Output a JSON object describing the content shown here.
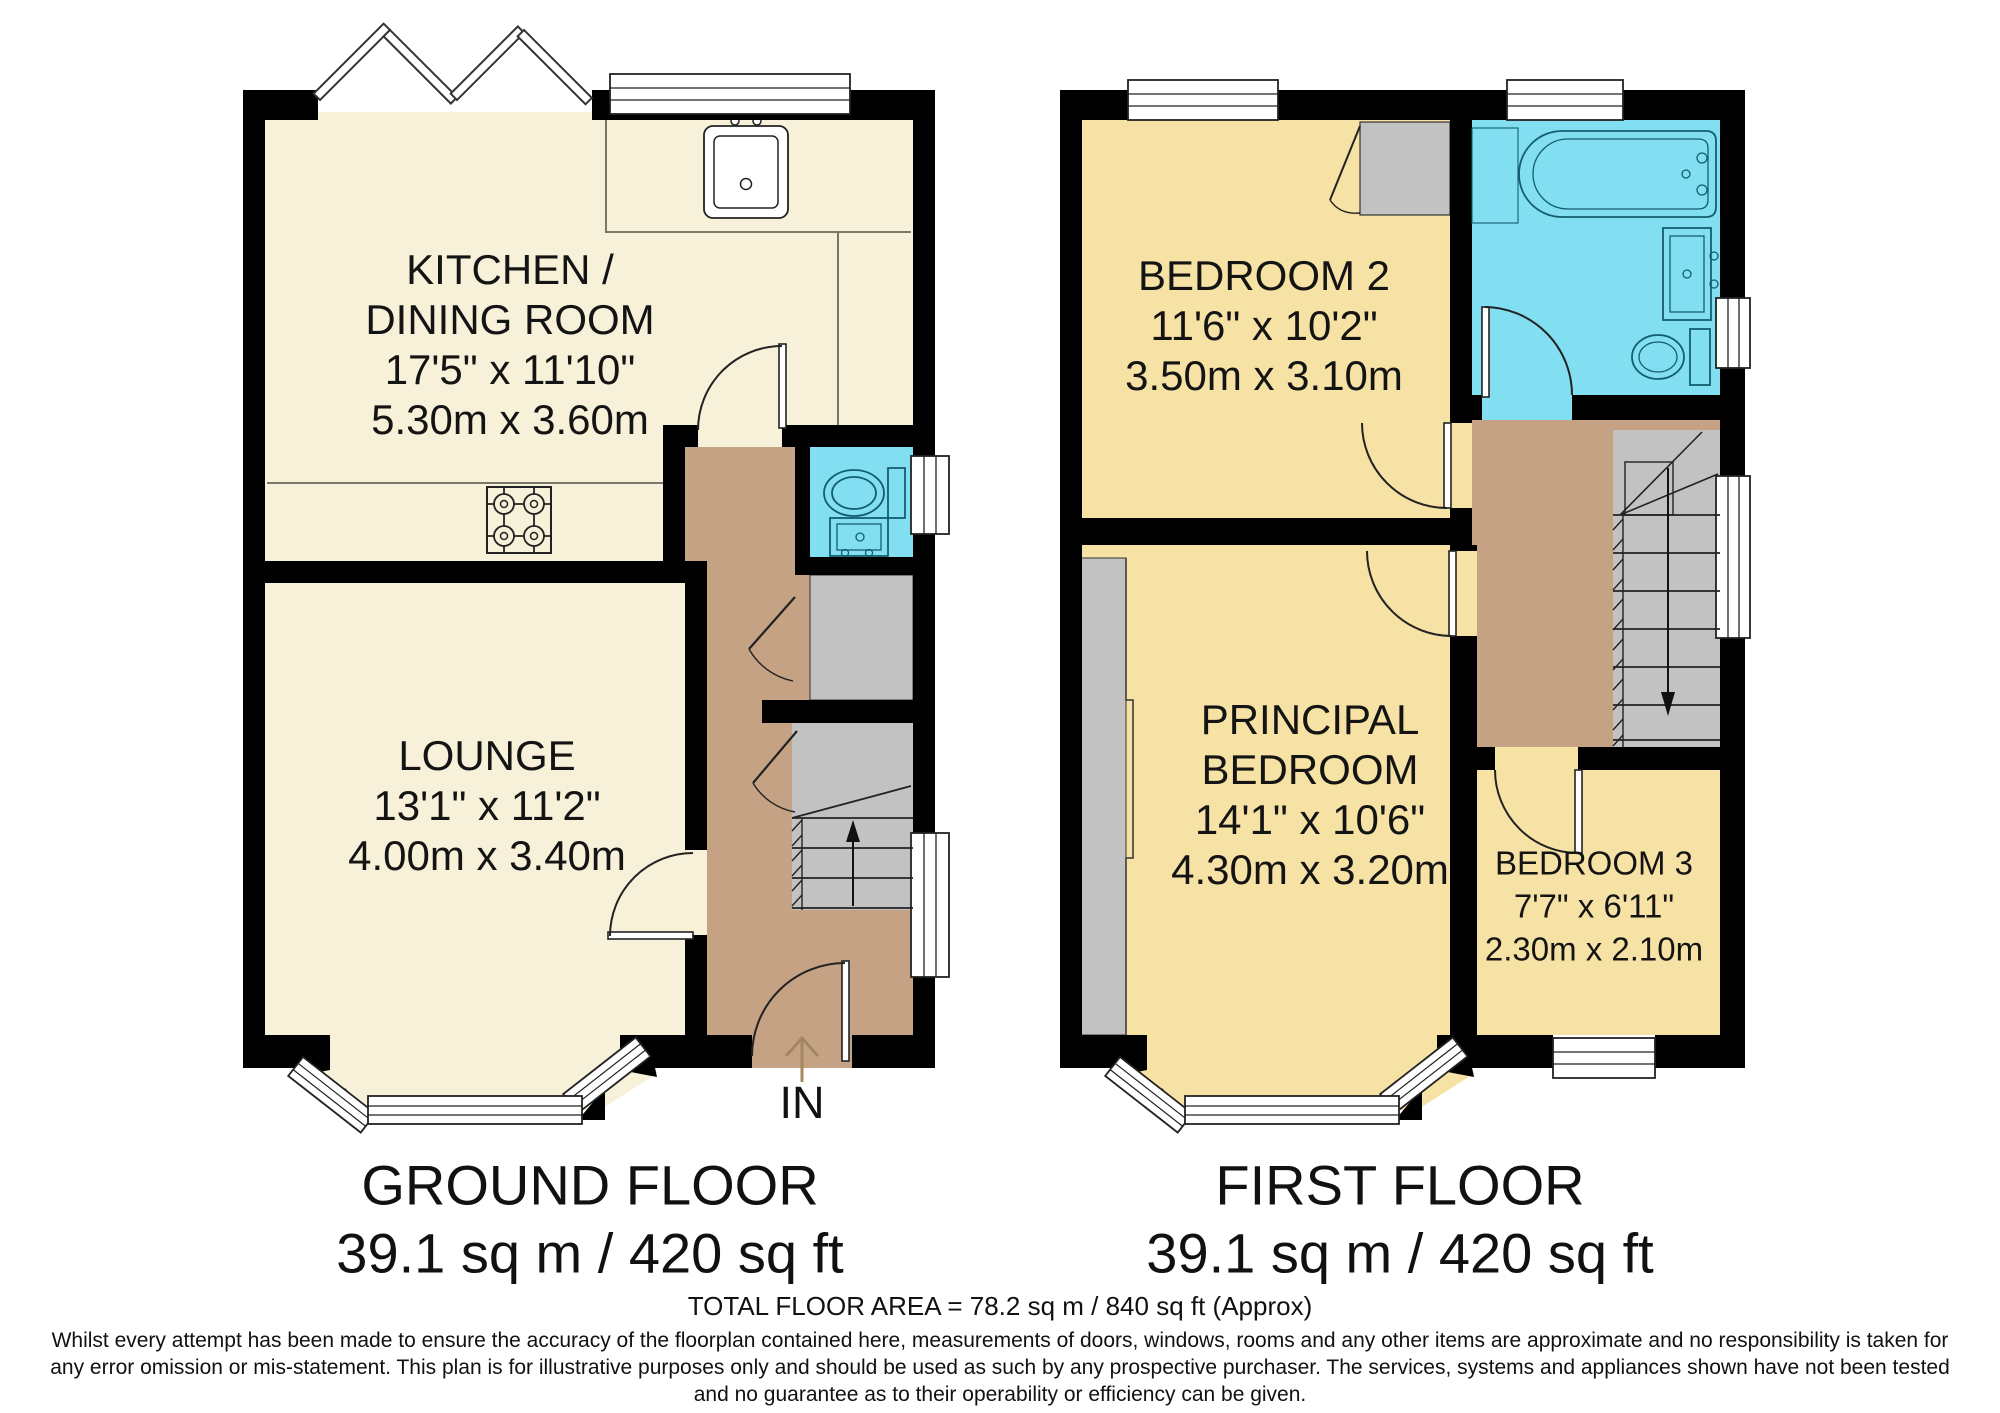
{
  "ground_floor": {
    "title": "GROUND FLOOR",
    "area": "39.1 sq m / 420 sq ft",
    "entrance_label": "IN",
    "rooms": {
      "kitchen_dining": {
        "name_line1": "KITCHEN /",
        "name_line2": "DINING ROOM",
        "size_imperial": "17'5\" x 11'10\"",
        "size_metric": "5.30m x 3.60m"
      },
      "lounge": {
        "name_line1": "LOUNGE",
        "size_imperial": "13'1\" x 11'2\"",
        "size_metric": "4.00m x 3.40m"
      }
    }
  },
  "first_floor": {
    "title": "FIRST FLOOR",
    "area": "39.1 sq m / 420 sq ft",
    "rooms": {
      "bedroom2": {
        "name_line1": "BEDROOM 2",
        "size_imperial": "11'6\" x 10'2\"",
        "size_metric": "3.50m x 3.10m"
      },
      "principal_bedroom": {
        "name_line1": "PRINCIPAL",
        "name_line2": "BEDROOM",
        "size_imperial": "14'1\" x 10'6\"",
        "size_metric": "4.30m x 3.20m"
      },
      "bedroom3": {
        "name_line1": "BEDROOM 3",
        "size_imperial": "7'7\" x 6'11\"",
        "size_metric": "2.30m x 2.10m"
      }
    }
  },
  "footer": {
    "total_area": "TOTAL FLOOR AREA = 78.2 sq m / 840 sq ft (Approx)",
    "disclaimer": "Whilst every attempt has been made to ensure the accuracy of the floorplan contained here, measurements of doors, windows, rooms and any other items are approximate and no responsibility is taken for any error omission or mis-statement. This plan is for illustrative purposes only and should be used as such by any prospective purchaser. The services, systems and appliances shown have not been tested and no guarantee as to their operability or efficiency can be given."
  },
  "colors": {
    "wall": "#000000",
    "ground_room_fill": "#F8F1DA",
    "first_room_fill": "#F7E2A5",
    "hall_fill": "#C5A284",
    "wet_room_fill": "#82DEF1",
    "storage_fill": "#C2C2C2",
    "entrance_arrow": "#A3875F"
  }
}
